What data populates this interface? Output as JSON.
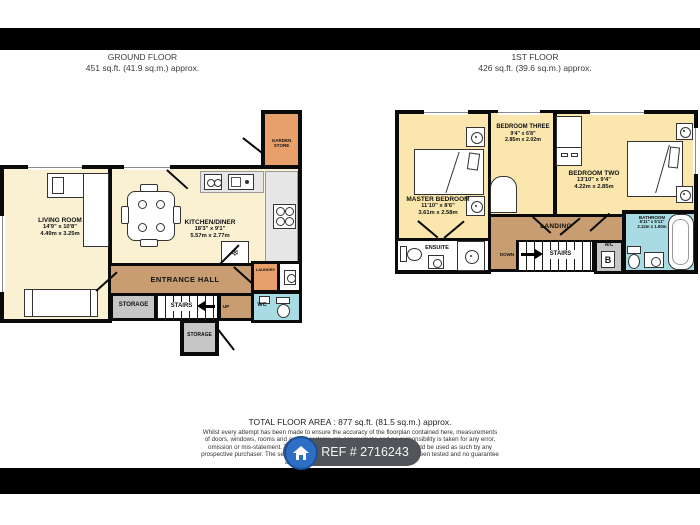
{
  "headers": {
    "ground": {
      "title": "GROUND FLOOR",
      "area": "451 sq.ft. (41.9 sq.m.) approx."
    },
    "first": {
      "title": "1ST FLOOR",
      "area": "426 sq.ft. (39.6 sq.m.) approx."
    }
  },
  "ground": {
    "living": {
      "name": "LIVING ROOM",
      "imperial": "14'9\" x 10'8\"",
      "metric": "4.49m x 3.25m"
    },
    "kitchen": {
      "name": "KITCHEN/DINER",
      "imperial": "18'3\" x 9'1\"",
      "metric": "5.57m x 2.77m"
    },
    "hall": {
      "name": "ENTRANCE HALL"
    },
    "storage1": {
      "name": "STORAGE"
    },
    "storage2": {
      "name": "STORAGE"
    },
    "stairs": {
      "name": "STAIRS",
      "direction": "UP"
    },
    "laundry": {
      "name": "LAUNDRY"
    },
    "wc": {
      "name": "WC"
    },
    "garden": {
      "name": "GARDEN STORE"
    }
  },
  "first": {
    "master": {
      "name": "MASTER BEDROOM",
      "imperial": "11'10\" x 8'6\"",
      "metric": "3.61m x 2.58m"
    },
    "bed3": {
      "name": "BEDROOM THREE",
      "imperial": "9'4\" x 6'8\"",
      "metric": "2.85m x 2.02m"
    },
    "bed2": {
      "name": "BEDROOM TWO",
      "imperial": "13'10\" x 9'4\"",
      "metric": "4.22m x 2.85m"
    },
    "ensuite": {
      "name": "ENSUITE"
    },
    "landing": {
      "name": "LANDING"
    },
    "stairs": {
      "name": "STAIRS",
      "direction": "DOWN"
    },
    "ac": {
      "name": "A/C",
      "boiler": "B"
    },
    "bathroom": {
      "name": "BATHROOM",
      "imperial": "6'11\" x 5'11\"",
      "metric": "2.12m x 1.80m"
    }
  },
  "icons": {
    "snowflake": "❄"
  },
  "footer": {
    "total": "TOTAL FLOOR AREA : 877 sq.ft. (81.5 sq.m.) approx.",
    "disclaimer": [
      "Whilst every attempt has been made to ensure the accuracy of the floorplan contained here, measurements",
      "of doors, windows, rooms and any other items are approximate and no responsibility is taken for any error,",
      "omission or mis-statement. This plan is for illustrative purposes only and should be used as such by any",
      "prospective purchaser. The services, systems and appliances shown have not been tested and no guarantee",
      "as to their operability or efficiency can be given."
    ],
    "attribution": "Made with Metropix ©2023",
    "ref": "REF # 2716243"
  },
  "colors": {
    "wall": "#0a0a0a",
    "room_cream": "#faf0d2",
    "room_yellow": "#fbe7ad",
    "hall_tan": "#c79d71",
    "store_orange": "#e8a06b",
    "wet_blue": "#a8dbe3",
    "storage_gray": "#c6c6c6",
    "badge_bg": "#51555a",
    "badge_circle": "#2d6fc5"
  }
}
